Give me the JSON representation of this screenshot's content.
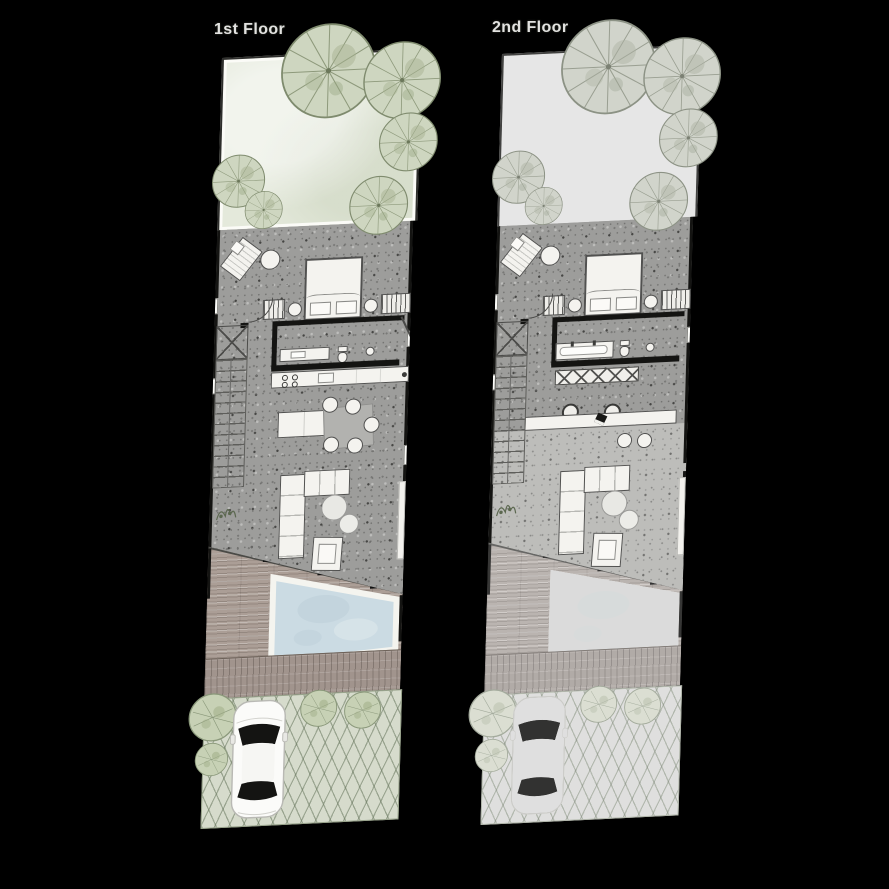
{
  "page": {
    "background_color": "#000000",
    "width": 889,
    "height": 889
  },
  "floors": [
    {
      "label": "1st Floor",
      "context_muted": false,
      "features": [
        "garden",
        "trees",
        "lounge-chair",
        "side-table",
        "bed",
        "pillows",
        "nightstands",
        "wardrobes",
        "bathroom-vanity",
        "toilet",
        "wash-basin",
        "kitchen-counter",
        "cooktop",
        "sink",
        "kitchen-island",
        "dining-table",
        "dining-chairs",
        "staircase",
        "sectional-sofa",
        "coffee-tables",
        "armchair",
        "tv-console",
        "potted-plant",
        "wood-deck",
        "pool",
        "driveway",
        "shrubs",
        "car"
      ]
    },
    {
      "label": "2nd Floor",
      "context_muted": true,
      "features": [
        "garden",
        "trees",
        "lounge-chair",
        "side-table",
        "bed",
        "pillows",
        "nightstands",
        "wardrobes",
        "bathtub",
        "toilet",
        "wash-basin",
        "closet",
        "study-desk",
        "bar-stools",
        "laptop",
        "ottomans",
        "staircase",
        "sectional-sofa",
        "coffee-tables",
        "armchair",
        "tv-console",
        "potted-plant",
        "wood-deck",
        "pool",
        "driveway",
        "shrubs",
        "car"
      ]
    }
  ],
  "palette": {
    "background": "#000000",
    "garden": "#e4e9db",
    "garden_muted": "#eef1e8",
    "terrazzo_floor": "#9d9d9b",
    "terrazzo_light": "#bdbdba",
    "wall": "#141412",
    "furniture": "#f4f3ef",
    "wood_deck": "#ab9e96",
    "pool_water": "#cbdbe3",
    "driveway": "#d6dbcc",
    "tree_canopy": "#ced6c0",
    "car_body": "#fbfbf9",
    "title_text": "#f4f4f1"
  }
}
